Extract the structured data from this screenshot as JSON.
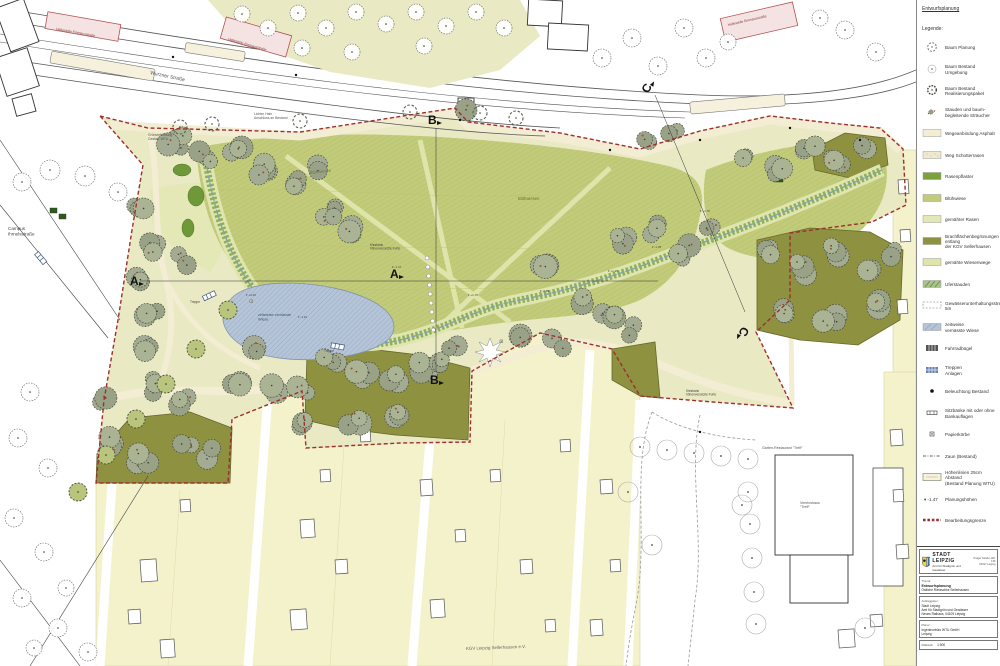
{
  "map": {
    "labels": [
      {
        "id": "street",
        "text": "Wurzner Straße"
      },
      {
        "id": "stop1",
        "text": "Haltestelle Emmausstraße"
      },
      {
        "id": "stop2",
        "text": "Haltestelle Emmausstraße"
      },
      {
        "id": "stop3",
        "text": "Haltestelle Emmausstraße"
      },
      {
        "id": "campus",
        "text": "Campus\nIhmelsstraße"
      },
      {
        "id": "lichter",
        "text": "Lichter Hain\nAnschluss an Bestand"
      },
      {
        "id": "gruen",
        "text": "Grünverbindung\nGestalt. WTU"
      },
      {
        "id": "bw1",
        "text": "Blühwiesen"
      },
      {
        "id": "bw2",
        "text": "Blühwiesen"
      },
      {
        "id": "pond",
        "text": "zeitweise vernässte\nWiese"
      },
      {
        "id": "treppe1",
        "text": "Treppe"
      },
      {
        "id": "treppe2",
        "text": "Treppe"
      },
      {
        "id": "kies1",
        "text": "Kiesbank\nhöhenversetzte Furte"
      },
      {
        "id": "kies2",
        "text": "Kiesbank\nhöhenversetzte Furte"
      },
      {
        "id": "kgv",
        "text": "KGV Leipzig Sellerhausen e.V."
      },
      {
        "id": "rest",
        "text": "Garten-Restaurant \"Treff\""
      },
      {
        "id": "verein",
        "text": "Vereinshaus\n\"Treff\""
      }
    ],
    "section_markers": [
      "A",
      "A",
      "B",
      "B",
      "C",
      "C"
    ],
    "elevations": [
      "-1.47",
      "+1.70",
      "-0.85",
      "+1.25",
      "-1.10",
      "+0.45",
      "-1.35",
      "+1.70"
    ]
  },
  "legend": {
    "doc_title": "Entwurfsplanung",
    "title": "Legende:",
    "items": [
      {
        "icon": "tree-plan",
        "label": "Baum Planung"
      },
      {
        "icon": "tree-bestand-u",
        "label": "Baum Bestand Umgebung"
      },
      {
        "icon": "tree-bestand-r",
        "label": "Baum Bestand\nRealisierungspaket"
      },
      {
        "icon": "shrub",
        "label": "Stauden und baum-\nbegleitende Sträucher"
      },
      {
        "icon": "sw-asphalt",
        "label": "Wegeanbindung Asphalt"
      },
      {
        "icon": "sw-schotter",
        "label": "Weg Schotterrasen"
      },
      {
        "icon": "sw-dark",
        "label": "Rasenpflaster"
      },
      {
        "icon": "sw-blueh",
        "label": "Blühwiese"
      },
      {
        "icon": "sw-rasen",
        "label": "gemähter Rasen"
      },
      {
        "icon": "sw-brach",
        "label": "Brachflächenbegrünungen entlang\nder KGV Sellerhausen"
      },
      {
        "icon": "sw-wweg",
        "label": "gemähte Wiesenwege"
      },
      {
        "icon": "sw-ufer",
        "label": "Uferstauden"
      },
      {
        "icon": "sw-gew",
        "label": "Gewässerunterhaltungsstreifen 5m"
      },
      {
        "icon": "sw-vern",
        "label": "zeitweise\nvernässte Wiese"
      },
      {
        "icon": "grid-dark",
        "label": "Fahrradbügel"
      },
      {
        "icon": "grid-blue",
        "label": "Treppen\nAnlagen"
      },
      {
        "icon": "dot",
        "label": "Beleuchtung Bestand"
      },
      {
        "icon": "bench",
        "label": "Sitzbänke mit oder ohne\nBankauflagen"
      },
      {
        "icon": "bin",
        "label": "Papierkörbe"
      },
      {
        "icon": "zaun",
        "label": "Zaun (Bestand)"
      },
      {
        "icon": "hoehen",
        "label": "Höhenlinien 25cm Abstand\n(Bestand Planung WTU)"
      },
      {
        "icon": "elev",
        "label": "Planungshöhen"
      },
      {
        "icon": "red-dash",
        "label": "Bearbeitungsgrenze"
      }
    ]
  },
  "titleblock": {
    "city": "STADT LEIPZIG",
    "office": "Amt für Stadtgrün und Gewässer",
    "addr1": "Prager Straße 118-136",
    "addr2": "04317 Leipzig",
    "thema_label": "Thema:",
    "thema1": "Entwurfsplanung",
    "thema2": "Östliche Rietzschke Sellerhausen",
    "client_label": "Auftraggeber:",
    "client1": "Stadt Leipzig",
    "client2": "Amt für Stadtgrün und Gewässer",
    "client3": "Neues Rathaus, 04109 Leipzig",
    "planer_label": "Planer:",
    "planer1": "Ingenieurbüro WTU GmbH",
    "planer2": "Leipzig",
    "scale_label": "Maßstab:",
    "scale": "1:500"
  }
}
